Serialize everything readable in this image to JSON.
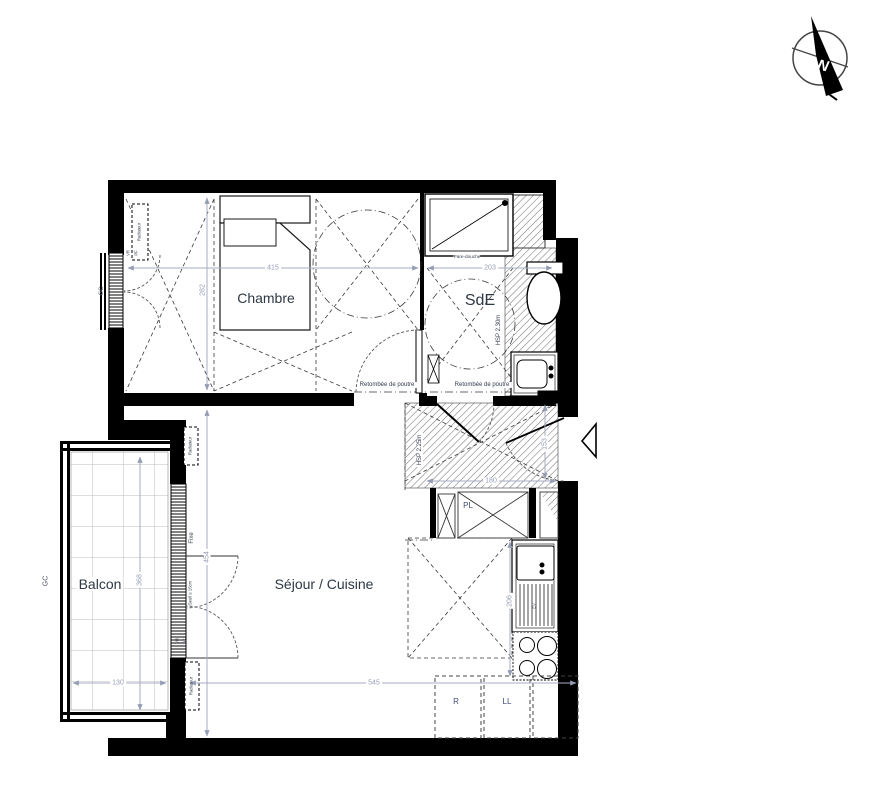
{
  "compass": {
    "north": "N"
  },
  "rooms": {
    "chambre": {
      "label": "Chambre"
    },
    "sde": {
      "label": "SdE"
    },
    "sejour": {
      "label": "Séjour / Cuisine"
    },
    "balcon": {
      "label": "Balcon"
    }
  },
  "annotations": {
    "beam": "Retombée de poutre",
    "ceiling_sde": "HSP 2.30m",
    "ceiling_hall": "HSP 2.25m",
    "fixed_pane": "Fixe",
    "threshold": "Seuil ≤ 15cm",
    "shutter": "VR",
    "french_window": "PF",
    "guardrail": "GC",
    "radiator": "Radiateur",
    "closet": "PL",
    "fridge": "R",
    "washing_machine": "LL",
    "sink_unit": "EV",
    "shower_screen": "Pare-douche"
  },
  "dimensions_cm": {
    "chambre_width": "415",
    "chambre_depth": "282",
    "sde_width": "203",
    "hall_width": "180",
    "hall_depth": "153",
    "sejour_width": "545",
    "sejour_depth": "454",
    "balcon_width": "130",
    "balcon_depth": "368",
    "kitchen_run": "206"
  },
  "colors": {
    "wall": "#000000",
    "dimension_text": "#959db5",
    "label_text": "#2e3844",
    "hatch_line": "#777777"
  }
}
